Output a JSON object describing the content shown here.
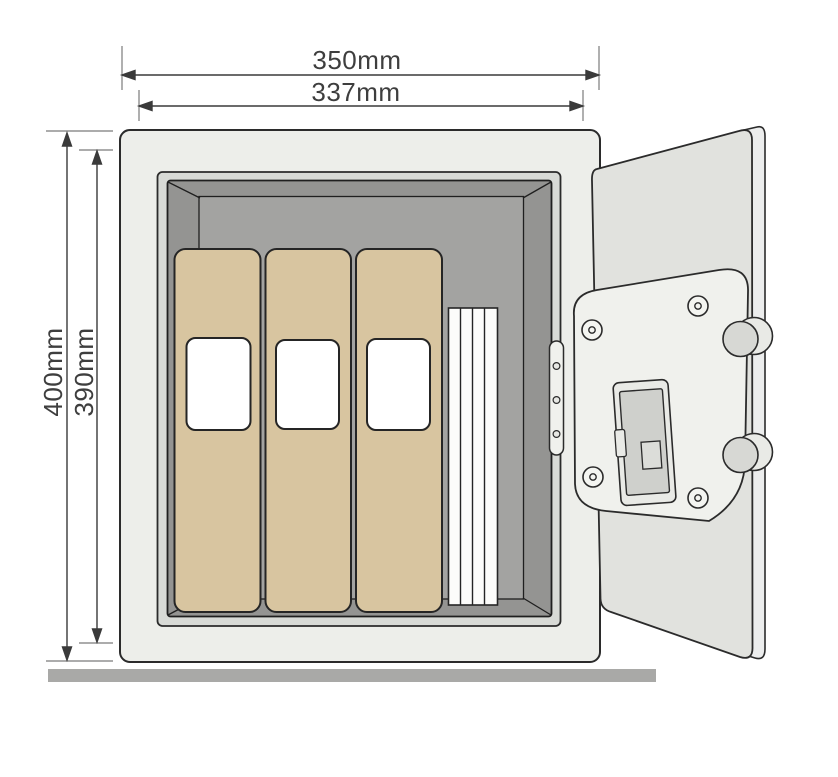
{
  "dimensions": {
    "outer_width": "350mm",
    "inner_width": "337mm",
    "outer_height": "400mm",
    "inner_height": "390mm"
  },
  "objects": {
    "safe_body": "safe cabinet front view with open interior",
    "binder_count": 3,
    "document_book_count": 4,
    "door": "open safe door with inner lock plate",
    "locking_bolt_count": 2,
    "door_plate_screw_count": 4,
    "hinge_screw_count": 3
  },
  "colors": {
    "body_fill": "#edeeea",
    "lip_fill": "#d8dad6",
    "interior_wall": "#949492",
    "interior_back": "#a3a3a1",
    "binder_tan": "#d8c5a0",
    "door_face": "#e1e2de",
    "door_plate": "#f0f1ed",
    "ground_bar": "#a9a9a7",
    "outline": "#2b2b2b",
    "dimension_text": "#3e3e3e"
  }
}
